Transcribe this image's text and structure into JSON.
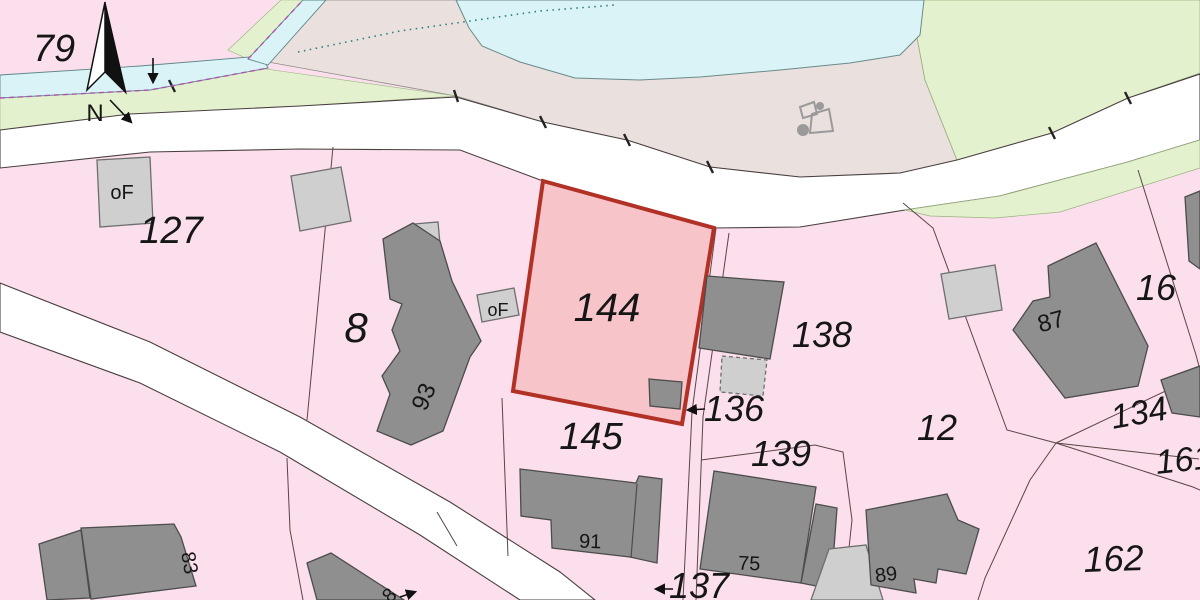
{
  "map": {
    "kind": "cadastral-parcel-map",
    "colors": {
      "parcel_pink": "#fbdfec",
      "open_area_beige": "#eae0dd",
      "water_blue": "#d9f3f6",
      "green_area": "#e4f1cf",
      "road_white": "#ffffff",
      "building_dark": "#8f8f8f",
      "building_dark_stroke": "#4c4c4c",
      "building_light": "#cfcfcf",
      "building_light_stroke": "#6e6e6e",
      "highlight_fill": "#f7c5c9",
      "highlight_stroke": "#b23127",
      "boundary_line": "#5a4444",
      "stream_dash": "#b050b0",
      "dotted_line": "#2a7f7f",
      "label_color": "#161616"
    },
    "north_arrow": {
      "label": "N"
    },
    "parcels": [
      {
        "id": "79",
        "label": "79",
        "x": 54,
        "y": 61,
        "size": 38,
        "rot": 0
      },
      {
        "id": "127",
        "label": "127",
        "x": 171,
        "y": 243,
        "size": 38,
        "rot": 0
      },
      {
        "id": "8",
        "label": "8",
        "x": 356,
        "y": 342,
        "size": 42,
        "rot": 0
      },
      {
        "id": "144",
        "label": "144",
        "x": 607,
        "y": 321,
        "size": 40,
        "rot": 0,
        "highlighted": true
      },
      {
        "id": "145",
        "label": "145",
        "x": 591,
        "y": 449,
        "size": 38,
        "rot": 0
      },
      {
        "id": "136",
        "label": "136",
        "x": 734,
        "y": 421,
        "size": 36,
        "rot": 0
      },
      {
        "id": "138",
        "label": "138",
        "x": 822,
        "y": 347,
        "size": 36,
        "rot": 0
      },
      {
        "id": "139",
        "label": "139",
        "x": 781,
        "y": 466,
        "size": 36,
        "rot": 0
      },
      {
        "id": "137",
        "label": "137",
        "x": 699,
        "y": 598,
        "size": 36,
        "rot": 0
      },
      {
        "id": "12",
        "label": "12",
        "x": 937,
        "y": 440,
        "size": 36,
        "rot": 0
      },
      {
        "id": "16",
        "label": "16",
        "x": 1156,
        "y": 300,
        "size": 36,
        "rot": 0
      },
      {
        "id": "134",
        "label": "134",
        "x": 1141,
        "y": 424,
        "size": 34,
        "rot": -10
      },
      {
        "id": "161",
        "label": "161",
        "x": 1185,
        "y": 471,
        "size": 34,
        "rot": -6
      },
      {
        "id": "162",
        "label": "162",
        "x": 1114,
        "y": 571,
        "size": 36,
        "rot": -2
      }
    ],
    "buildings": [
      {
        "id": "house-of-127",
        "fill": "light",
        "points": "97,160 150,157 153,223 100,227",
        "label": {
          "text": "oF",
          "x": 122,
          "y": 199,
          "size": 20,
          "rot": 0
        }
      },
      {
        "id": "house-127-b",
        "fill": "light",
        "points": "291,176 341,167 351,221 300,231"
      },
      {
        "id": "house-93-annex",
        "fill": "light",
        "points": "414,224 438,222 440,244 416,246"
      },
      {
        "id": "house-93",
        "fill": "dark",
        "points": "383,239 413,223 440,241 452,281 481,341 470,357 443,431 411,445 377,431 390,394 382,376 400,351 392,330 402,304 390,299",
        "label": {
          "text": "93",
          "x": 431,
          "y": 400,
          "size": 24,
          "rot": -66
        }
      },
      {
        "id": "house-of-144",
        "fill": "light",
        "points": "477,295 514,288 519,315 482,322",
        "label": {
          "text": "oF",
          "x": 498,
          "y": 316,
          "size": 18,
          "rot": 0
        }
      },
      {
        "id": "shed-144",
        "fill": "dark",
        "points": "649,379 682,382 680,409 650,406"
      },
      {
        "id": "house-138",
        "fill": "dark",
        "points": "707,276 784,282 770,359 699,348"
      },
      {
        "id": "annex-138",
        "fill": "light",
        "dashed": true,
        "points": "722,356 767,360 763,396 720,392"
      },
      {
        "id": "house-16-small",
        "fill": "light",
        "points": "941,274 995,265 1002,310 949,319"
      },
      {
        "id": "house-87",
        "fill": "dark",
        "points": "1048,266 1096,243 1148,346 1138,386 1065,398 1013,330 1033,301 1050,297",
        "label": {
          "text": "87",
          "x": 1053,
          "y": 329,
          "size": 24,
          "rot": -15
        }
      },
      {
        "id": "house-134",
        "fill": "dark",
        "points": "1161,380 1200,366 1200,417 1172,413"
      },
      {
        "id": "house-ne-edge",
        "fill": "dark",
        "points": "1185,197 1200,191 1200,269 1189,261"
      },
      {
        "id": "house-91",
        "fill": "dark",
        "points": "520,469 636,483 639,476 662,479 657,563 630,557 552,548 551,520 521,516",
        "divider": "637,484 631,558",
        "label": {
          "text": "91",
          "x": 590,
          "y": 548,
          "size": 20,
          "rot": 2
        }
      },
      {
        "id": "house-75",
        "fill": "dark",
        "points": "714,471 816,487 801,583 700,569",
        "label": {
          "text": "75",
          "x": 749,
          "y": 570,
          "size": 20,
          "rot": 2
        }
      },
      {
        "id": "annex-75",
        "fill": "dark",
        "points": "816,504 837,508 831,589 801,583"
      },
      {
        "id": "yard-89",
        "fill": "light",
        "points": "829,549 866,545 883,600 811,600"
      },
      {
        "id": "house-89",
        "fill": "dark",
        "points": "866,510 947,494 958,520 979,529 966,574 938,569 936,583 914,579 916,593 871,585",
        "label": {
          "text": "89",
          "x": 887,
          "y": 581,
          "size": 20,
          "rot": -8
        }
      },
      {
        "id": "annex-83",
        "fill": "dark",
        "points": "39,544 81,530 90,598 47,600"
      },
      {
        "id": "house-83",
        "fill": "dark",
        "points": "81,528 174,524 181,537 196,586 91,599",
        "label": {
          "text": "83",
          "x": 183,
          "y": 564,
          "size": 20,
          "rot": 80
        }
      },
      {
        "id": "house-sw",
        "fill": "dark",
        "points": "307,563 331,553 404,600 317,600",
        "label": {
          "text": "8",
          "x": 394,
          "y": 600,
          "size": 20,
          "rot": -45
        }
      }
    ],
    "arrows": [
      {
        "id": "arrow-parcel-79",
        "x1": 153,
        "y1": 58,
        "x2": 153,
        "y2": 82
      },
      {
        "id": "arrow-north",
        "x1": 110,
        "y1": 100,
        "x2": 131,
        "y2": 122
      },
      {
        "id": "arrow-parcel-136",
        "x1": 705,
        "y1": 409,
        "x2": 688,
        "y2": 410
      },
      {
        "id": "arrow-parcel-137",
        "x1": 673,
        "y1": 589,
        "x2": 656,
        "y2": 589
      },
      {
        "id": "arrow-house-sw",
        "x1": 400,
        "y1": 597,
        "x2": 415,
        "y2": 592
      }
    ],
    "point_symbols": [
      {
        "id": "symbol-dot-large",
        "type": "circle",
        "x": 803,
        "y": 130,
        "r": 6
      },
      {
        "id": "symbol-dot-small",
        "type": "circle",
        "x": 820,
        "y": 106,
        "r": 4
      },
      {
        "id": "symbol-quad-small",
        "type": "quad",
        "points": "800,107 814,102 817,114 803,118"
      },
      {
        "id": "symbol-quad-large",
        "type": "quad",
        "points": "812,114 829,109 833,131 810,133"
      }
    ]
  }
}
